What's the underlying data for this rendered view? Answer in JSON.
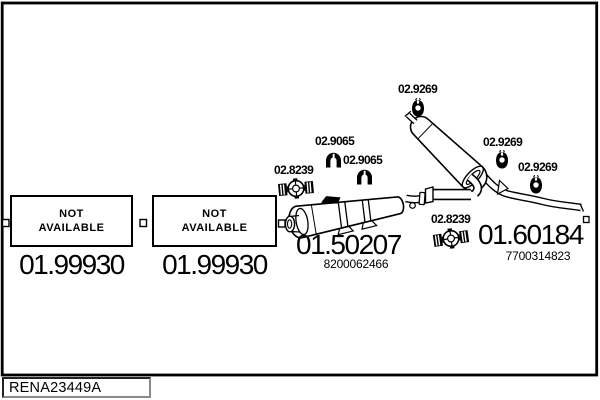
{
  "colors": {
    "line": "#000000",
    "background": "#ffffff",
    "text": "#000000"
  },
  "drawing_ref": "RENA23449A",
  "placeholder_boxes": [
    {
      "line1": "NOT",
      "line2": "AVAILABLE",
      "part_number": "01.99930"
    },
    {
      "line1": "NOT",
      "line2": "AVAILABLE",
      "part_number": "01.99930"
    }
  ],
  "mufflers": {
    "middle": {
      "part_number": "01.50207",
      "oem_number": "8200062466"
    },
    "rear": {
      "part_number": "01.60184",
      "oem_number": "7700314823"
    }
  },
  "mounting_parts": {
    "bracket_left": {
      "part_number": "02.8239"
    },
    "clamp_upper": {
      "part_number": "02.9065"
    },
    "clamp_lower": {
      "part_number": "02.9065"
    },
    "hanger_top": {
      "part_number": "02.9269"
    },
    "hanger_middle": {
      "part_number": "02.9269"
    },
    "hanger_right": {
      "part_number": "02.9269"
    },
    "bracket_right": {
      "part_number": "02.8239"
    }
  }
}
